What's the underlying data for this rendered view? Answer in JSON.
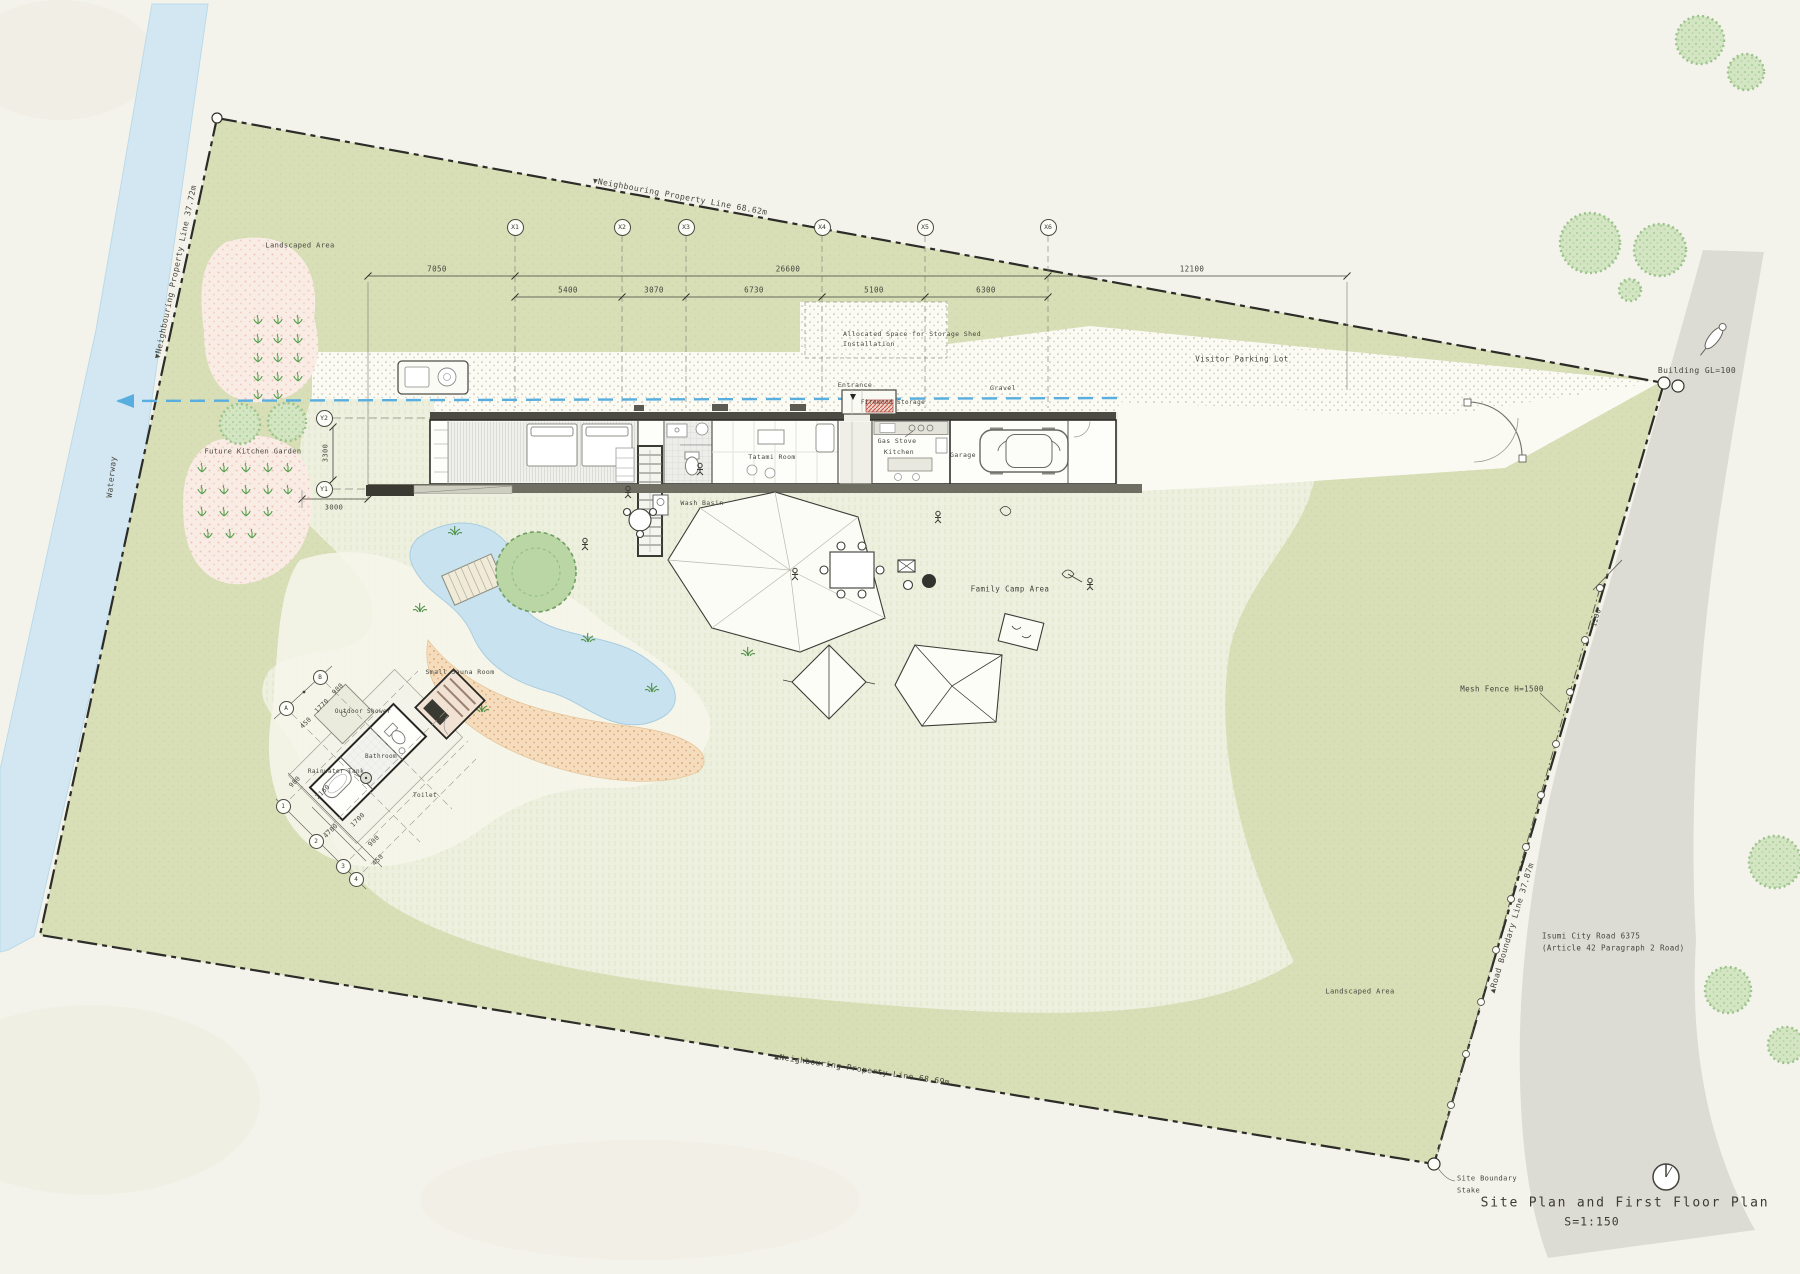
{
  "document": {
    "title": "Site Plan and First Floor Plan",
    "scale": "S=1:150"
  },
  "boundaries": {
    "top": "▼Neighbouring Property Line  68.62m",
    "left": "▼Neighbouring Property Line  37.72m",
    "bottom": "▲Neighbouring Property Line  68.69m",
    "road": "▲Road Boundary Line 37.87m",
    "stake_line1": "Site Boundary",
    "stake_line2": "Stake",
    "mesh_fence": "Mesh Fence H=1500",
    "building_gl": "Building GL=100",
    "waterway": "Waterway",
    "road_name_line1": "Isumi City Road 6375",
    "road_name_line2": "(Article 42 Paragraph 2 Road)"
  },
  "areas": {
    "landscaped_top": "Landscaped Area",
    "landscaped_bottom": "Landscaped Area",
    "future_kitchen_garden": "Future Kitchen Garden",
    "visitor_parking": "Visitor Parking Lot",
    "gravel": "Gravel",
    "family_camp": "Family Camp Area",
    "storage_line1": "Allocated Space for Storage Shed",
    "storage_line2": "Installation"
  },
  "rooms": {
    "entrance": "Entrance",
    "firewood": "Firewood Storage",
    "kitchen": "Kitchen",
    "gas_stove": "Gas Stove",
    "garage": "Garage",
    "tatami": "Tatami Room",
    "wash_basin": "Wash Basin",
    "small_sauna": "Small Sauna Room",
    "outdoor_shower": "Outdoor Shower",
    "bathroom": "Bathroom",
    "toilet": "Toilet",
    "rainwater_tank": "Rainwater Tank"
  },
  "grid": {
    "x": [
      "X1",
      "X2",
      "X3",
      "X4",
      "X5",
      "X6"
    ],
    "y": [
      "Y2",
      "Y1"
    ],
    "sauna_letters": [
      "A",
      "B"
    ],
    "sauna_numbers": [
      "1",
      "2",
      "3",
      "4"
    ]
  },
  "dimensions": {
    "left_total": "7050",
    "mid_total": "26600",
    "right_total": "12100",
    "x_spans": [
      "5400",
      "3070",
      "6730",
      "5100",
      "6300"
    ],
    "y_span": "3300",
    "west_offset": "3000",
    "fence_offset": "1200",
    "sauna_cross": [
      "450",
      "1770",
      "900"
    ],
    "sauna_long": [
      "900",
      "2160",
      "1700",
      "900",
      "450"
    ],
    "sauna_long_total": "4780"
  },
  "colors": {
    "paper": "#f4f3eb",
    "sage_green": "#d8deb6",
    "lawn": "#eef0df",
    "water_blue": "#d3e7f2",
    "gravel_white": "#fbfaf3",
    "road_gray": "#dddcd4",
    "sand": "#f4dcbd",
    "garden_pink": "#f9ece5",
    "supply_line_blue": "#58aede",
    "line_ink": "#2c2c28"
  }
}
